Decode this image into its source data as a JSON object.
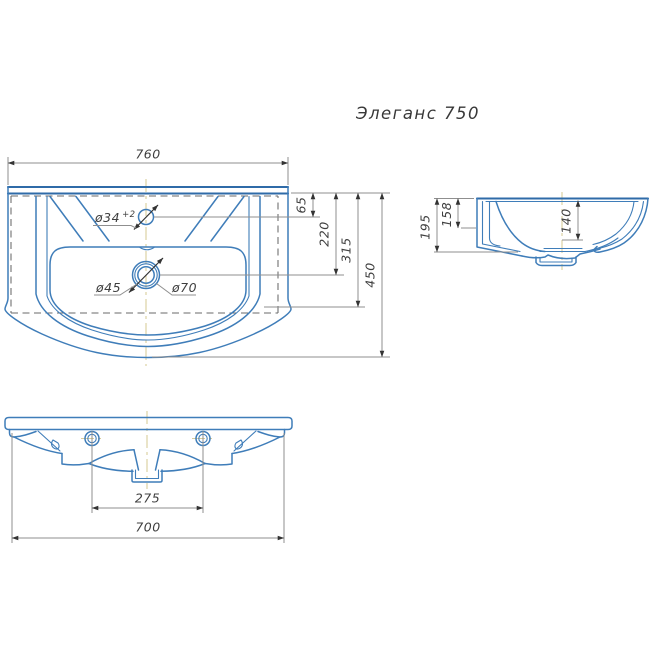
{
  "title": "Элеганс 750",
  "dimensions": {
    "top_width": "760",
    "faucet_offset": "65",
    "drain_offset": "220",
    "bowl_front_offset": "315",
    "overall_depth": "450",
    "faucet_hole_dia": "ø34",
    "faucet_hole_tolerance": "+2",
    "drain_inner_dia": "ø45",
    "drain_outer_dia": "ø70",
    "side_height": "195",
    "back_apron_height": "158",
    "bowl_depth": "140",
    "mount_hole_spacing": "275",
    "bottom_width": "700"
  },
  "colors": {
    "outline": "#3f7db9",
    "outline-strong": "#2f6ba8",
    "dim-line": "#8f8f8f",
    "dim-text": "#3f3f3f",
    "arrow": "#333333",
    "hidden-line": "#6a6a6a",
    "centerline": "#d9cd9b",
    "title-text": "#383838",
    "background": "#ffffff"
  }
}
